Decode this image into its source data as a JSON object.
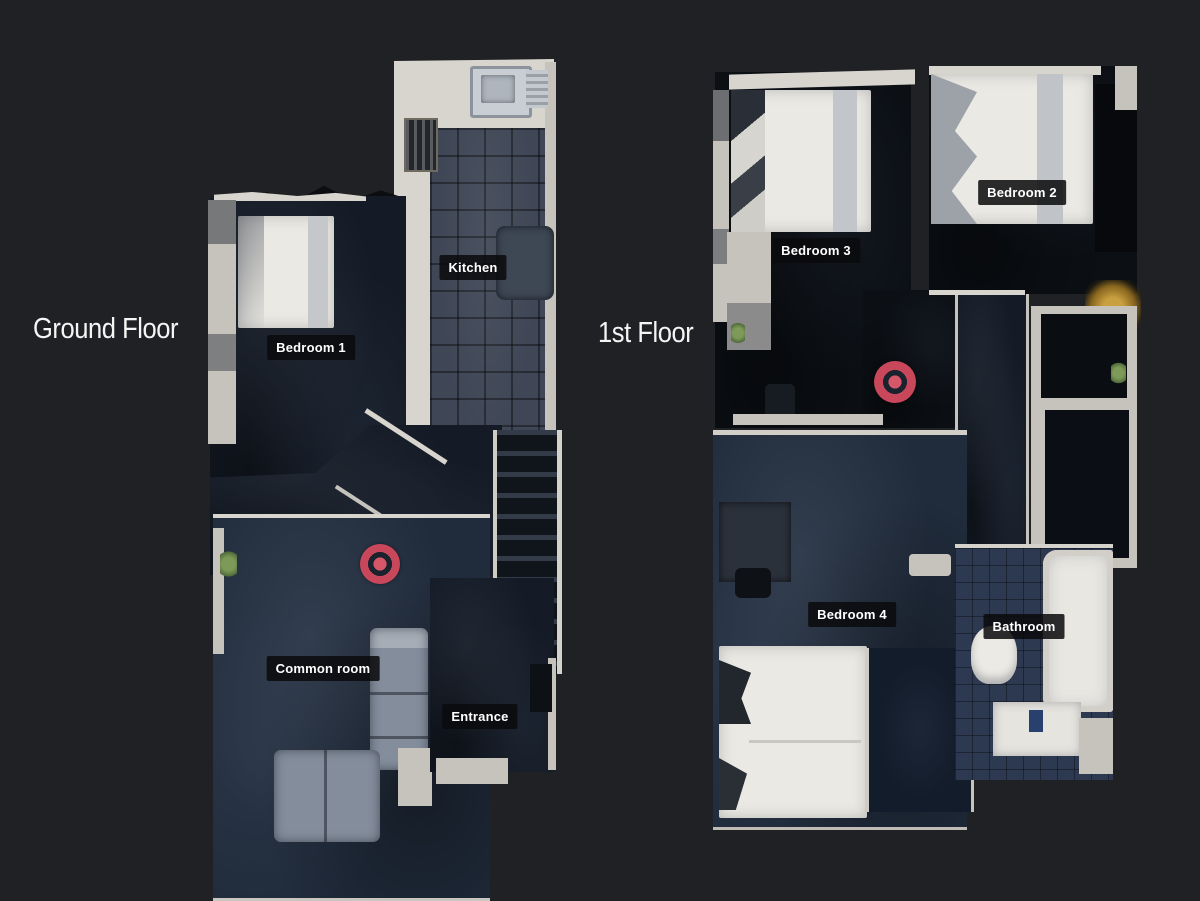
{
  "page": {
    "background_color": "#202124",
    "view": "dollhouse-floorplan"
  },
  "ground_floor": {
    "title": "Ground Floor",
    "rooms": {
      "bedroom1": "Bedroom 1",
      "kitchen": "Kitchen",
      "common_room": "Common room",
      "entrance": "Entrance"
    },
    "marker_icon": "scan-position-marker-icon"
  },
  "first_floor": {
    "title": "1st Floor",
    "rooms": {
      "bedroom3": "Bedroom 3",
      "bedroom2": "Bedroom 2",
      "bedroom4": "Bedroom 4",
      "bathroom": "Bathroom"
    },
    "marker_icon": "scan-position-marker-icon"
  },
  "colors": {
    "background": "#202124",
    "label_background": "rgba(11,11,13,0.86)",
    "label_text": "#ffffff",
    "marker_red": "#c9475b",
    "marker_ring_dark": "#1a222e",
    "carpet_dark_blue": "#202b3b",
    "wall_white": "#d8d5cf"
  }
}
